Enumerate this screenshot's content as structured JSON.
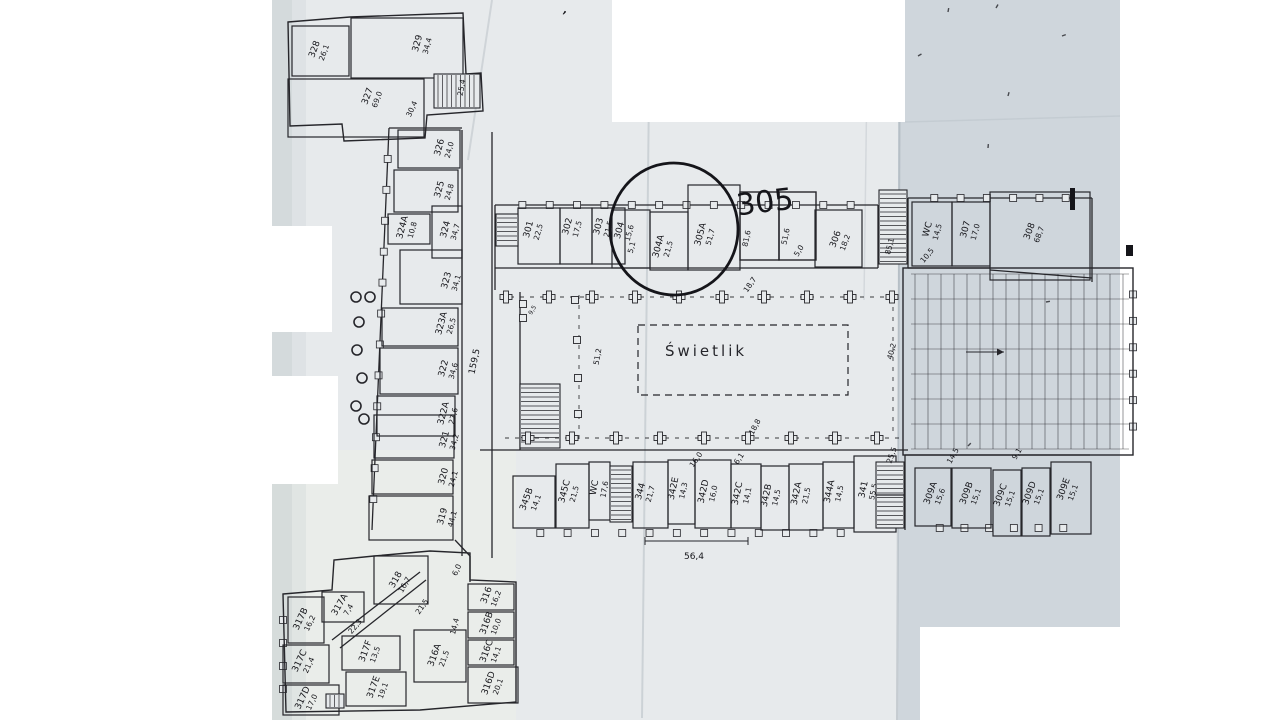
{
  "colors": {
    "bg": "#ffffff",
    "paper": "#e7eaec",
    "paper_right": "#cdd5db",
    "paper_warm": "#edeeea",
    "shadow": "#b9c2c6",
    "ink": "#26262b",
    "hand": "#15151a",
    "crease": "#8a95a0"
  },
  "paper": {
    "base": "272,0 1120,0 1120,627 920,627 920,720 272,720",
    "right": "898,0 1120,0 1120,627 920,627 920,720 898,720",
    "warm": "272,450 516,450 516,720 272,720"
  },
  "masks": [
    {
      "x": 612,
      "y": 0,
      "w": 293,
      "h": 122
    },
    {
      "x": 262,
      "y": 226,
      "w": 70,
      "h": 106
    },
    {
      "x": 256,
      "y": 376,
      "w": 82,
      "h": 108
    },
    {
      "x": 920,
      "y": 627,
      "w": 220,
      "h": 93
    }
  ],
  "creases": [
    {
      "x1": 650,
      "y1": 0,
      "x2": 642,
      "y2": 718,
      "o": 0.28,
      "w": 2
    },
    {
      "x1": 868,
      "y1": 0,
      "x2": 864,
      "y2": 300,
      "o": 0.2,
      "w": 1.5
    },
    {
      "x1": 900,
      "y1": 0,
      "x2": 897,
      "y2": 720,
      "o": 0.35,
      "w": 2
    },
    {
      "x1": 492,
      "y1": 0,
      "x2": 468,
      "y2": 160,
      "o": 0.25,
      "w": 2
    },
    {
      "x1": 905,
      "y1": 122,
      "x2": 1120,
      "y2": 116,
      "o": 0.15,
      "w": 1.5
    }
  ],
  "walls": {
    "lines": [
      {
        "x1": 462,
        "y1": 130,
        "x2": 462,
        "y2": 556
      },
      {
        "x1": 492,
        "y1": 132,
        "x2": 492,
        "y2": 290
      },
      {
        "x1": 492,
        "y1": 290,
        "x2": 492,
        "y2": 558
      },
      {
        "x1": 495,
        "y1": 205,
        "x2": 878,
        "y2": 205,
        "win": 13
      },
      {
        "x1": 495,
        "y1": 268,
        "x2": 878,
        "y2": 268
      },
      {
        "x1": 495,
        "y1": 205,
        "x2": 495,
        "y2": 290
      },
      {
        "x1": 878,
        "y1": 205,
        "x2": 878,
        "y2": 268
      },
      {
        "x1": 389,
        "y1": 128,
        "x2": 372,
        "y2": 530,
        "win": 12
      },
      {
        "x1": 389,
        "y1": 128,
        "x2": 462,
        "y2": 128
      },
      {
        "x1": 908,
        "y1": 198,
        "x2": 1092,
        "y2": 198,
        "win": 6
      },
      {
        "x1": 908,
        "y1": 198,
        "x2": 908,
        "y2": 268
      },
      {
        "x1": 1092,
        "y1": 198,
        "x2": 1092,
        "y2": 282
      },
      {
        "x1": 908,
        "y1": 268,
        "x2": 990,
        "y2": 268
      },
      {
        "x1": 990,
        "y1": 270,
        "x2": 1092,
        "y2": 278
      },
      {
        "x1": 1133,
        "y1": 268,
        "x2": 1133,
        "y2": 453,
        "win": 6,
        "only": 1
      },
      {
        "x1": 480,
        "y1": 450,
        "x2": 908,
        "y2": 450
      },
      {
        "x1": 905,
        "y1": 455,
        "x2": 1090,
        "y2": 455
      },
      {
        "x1": 513,
        "y1": 533,
        "x2": 868,
        "y2": 533,
        "win": 12,
        "only": 1
      },
      {
        "x1": 915,
        "y1": 528,
        "x2": 1088,
        "y2": 528,
        "win": 6,
        "only": 1
      },
      {
        "x1": 283,
        "y1": 597,
        "x2": 283,
        "y2": 712,
        "win": 4,
        "only": 1
      },
      {
        "x1": 455,
        "y1": 540,
        "x2": 470,
        "y2": 556
      },
      {
        "x1": 470,
        "y1": 556,
        "x2": 470,
        "y2": 582
      },
      {
        "x1": 332,
        "y1": 640,
        "x2": 420,
        "y2": 572
      },
      {
        "x1": 340,
        "y1": 648,
        "x2": 426,
        "y2": 580
      },
      {
        "x1": 905,
        "y1": 455,
        "x2": 905,
        "y2": 530
      },
      {
        "x1": 520,
        "y1": 292,
        "x2": 520,
        "y2": 450
      }
    ],
    "polys": [
      "283,594 332,590 334,560 374,556 430,551 470,553 470,580 516,582 516,702 420,710 286,712",
      "288,22 350,17 463,13 466,74 481,73 483,111 427,115 425,138 344,141 342,124 290,126"
    ],
    "rects": [
      {
        "x": 903,
        "y": 268,
        "w": 230,
        "h": 187
      },
      {
        "x": 740,
        "y": 192,
        "w": 39,
        "h": 68
      },
      {
        "x": 779,
        "y": 192,
        "w": 37,
        "h": 68
      }
    ]
  },
  "rooms": [
    {
      "id": "328",
      "area": "26,1",
      "x": 292,
      "y": 26,
      "w": 57,
      "h": 50,
      "lx": 317,
      "ly": 50,
      "rot": -70
    },
    {
      "id": "329",
      "area": "34,4",
      "x": 351,
      "y": 18,
      "w": 112,
      "h": 60,
      "lx": 420,
      "ly": 44,
      "rot": -75
    },
    {
      "id": "327",
      "area": "69,0",
      "x": 288,
      "y": 79,
      "w": 136,
      "h": 58,
      "lx": 370,
      "ly": 97,
      "rot": -70
    },
    {
      "id": "326",
      "area": "24,0",
      "x": 398,
      "y": 130,
      "w": 62,
      "h": 38,
      "lx": 442,
      "ly": 148,
      "rot": -75
    },
    {
      "id": "325",
      "area": "24,8",
      "x": 394,
      "y": 170,
      "w": 64,
      "h": 42,
      "lx": 442,
      "ly": 190,
      "rot": -75
    },
    {
      "id": "324A",
      "area": "10,8",
      "x": 388,
      "y": 214,
      "w": 42,
      "h": 30,
      "lx": 405,
      "ly": 228,
      "rot": -75
    },
    {
      "id": "324",
      "area": "34,7",
      "x": 432,
      "y": 206,
      "w": 30,
      "h": 52,
      "lx": 448,
      "ly": 230,
      "rot": -75
    },
    {
      "id": "323",
      "area": "34,1",
      "x": 400,
      "y": 250,
      "w": 62,
      "h": 54,
      "lx": 449,
      "ly": 281,
      "rot": -75
    },
    {
      "id": "323A",
      "area": "26,5",
      "x": 382,
      "y": 308,
      "w": 76,
      "h": 38,
      "lx": 444,
      "ly": 324,
      "rot": -75
    },
    {
      "id": "322",
      "area": "34,6",
      "x": 380,
      "y": 348,
      "w": 78,
      "h": 46,
      "lx": 446,
      "ly": 369,
      "rot": -75
    },
    {
      "id": "322A",
      "area": "27,6",
      "x": 377,
      "y": 396,
      "w": 78,
      "h": 40,
      "lx": 446,
      "ly": 414,
      "rot": -75
    },
    {
      "id": "321",
      "area": "34,2",
      "x": 374,
      "y": 415,
      "w": 80,
      "h": 43,
      "lx": 447,
      "ly": 440,
      "rot": -75
    },
    {
      "id": "320",
      "area": "24,1",
      "x": 372,
      "y": 460,
      "w": 81,
      "h": 34,
      "lx": 446,
      "ly": 477,
      "rot": -75
    },
    {
      "id": "319",
      "area": "44,1",
      "x": 369,
      "y": 496,
      "w": 84,
      "h": 44,
      "lx": 445,
      "ly": 517,
      "rot": -75
    },
    {
      "id": "318",
      "area": "16,7",
      "x": 374,
      "y": 556,
      "w": 54,
      "h": 48,
      "lx": 398,
      "ly": 581,
      "rot": -60
    },
    {
      "id": "317A",
      "area": "7,4",
      "x": 322,
      "y": 592,
      "w": 42,
      "h": 30,
      "lx": 342,
      "ly": 606,
      "rot": -60
    },
    {
      "id": "317B",
      "area": "16,2",
      "x": 288,
      "y": 597,
      "w": 36,
      "h": 46,
      "lx": 303,
      "ly": 620,
      "rot": -65
    },
    {
      "id": "317C",
      "area": "21,4",
      "x": 283,
      "y": 645,
      "w": 46,
      "h": 38,
      "lx": 302,
      "ly": 662,
      "rot": -65
    },
    {
      "id": "317D",
      "area": "17,0",
      "x": 283,
      "y": 685,
      "w": 56,
      "h": 30,
      "lx": 305,
      "ly": 699,
      "rot": -65
    },
    {
      "id": "317F",
      "area": "13,5",
      "x": 342,
      "y": 636,
      "w": 58,
      "h": 34,
      "lx": 368,
      "ly": 652,
      "rot": -70
    },
    {
      "id": "317E",
      "area": "19,1",
      "x": 346,
      "y": 672,
      "w": 60,
      "h": 34,
      "lx": 376,
      "ly": 688,
      "rot": -70
    },
    {
      "id": "316A",
      "area": "21,5",
      "x": 414,
      "y": 630,
      "w": 52,
      "h": 52,
      "lx": 437,
      "ly": 656,
      "rot": -70
    },
    {
      "id": "316",
      "area": "16,2",
      "x": 468,
      "y": 584,
      "w": 46,
      "h": 26,
      "lx": 489,
      "ly": 596,
      "rot": -70
    },
    {
      "id": "316B",
      "area": "10,0",
      "x": 468,
      "y": 612,
      "w": 46,
      "h": 26,
      "lx": 489,
      "ly": 624,
      "rot": -70
    },
    {
      "id": "316C",
      "area": "14,1",
      "x": 468,
      "y": 640,
      "w": 46,
      "h": 25,
      "lx": 489,
      "ly": 652,
      "rot": -70
    },
    {
      "id": "316D",
      "area": "20,1",
      "x": 468,
      "y": 667,
      "w": 50,
      "h": 36,
      "lx": 491,
      "ly": 684,
      "rot": -70
    },
    {
      "id": "301",
      "area": "22,5",
      "x": 518,
      "y": 208,
      "w": 42,
      "h": 56,
      "lx": 531,
      "ly": 230,
      "rot": -75
    },
    {
      "id": "302",
      "area": "17,5",
      "x": 560,
      "y": 208,
      "w": 32,
      "h": 56,
      "lx": 570,
      "ly": 227,
      "rot": -75
    },
    {
      "id": "303",
      "area": "21,5",
      "x": 592,
      "y": 208,
      "w": 33,
      "h": 56,
      "lx": 601,
      "ly": 227,
      "rot": -75
    },
    {
      "id": "304",
      "area": "15,6",
      "x": 612,
      "y": 210,
      "w": 38,
      "h": 58,
      "lx": 622,
      "ly": 231,
      "rot": -75
    },
    {
      "id": "304A",
      "area": "21,5",
      "x": 650,
      "y": 212,
      "w": 38,
      "h": 58,
      "lx": 661,
      "ly": 247,
      "rot": -75
    },
    {
      "id": "305A",
      "area": "51,7",
      "x": 688,
      "y": 185,
      "w": 52,
      "h": 85,
      "lx": 703,
      "ly": 235,
      "rot": -75
    },
    {
      "id": "306",
      "area": "18,2",
      "x": 815,
      "y": 210,
      "w": 47,
      "h": 57,
      "lx": 838,
      "ly": 240,
      "rot": -70
    },
    {
      "id": "WC",
      "area": "14,5",
      "x": 912,
      "y": 202,
      "w": 40,
      "h": 64,
      "lx": 930,
      "ly": 230,
      "rot": -75
    },
    {
      "id": "307",
      "area": "17,0",
      "x": 952,
      "y": 202,
      "w": 38,
      "h": 64,
      "lx": 968,
      "ly": 230,
      "rot": -75
    },
    {
      "id": "308",
      "area": "68,7",
      "x": 990,
      "y": 192,
      "w": 100,
      "h": 88,
      "lx": 1032,
      "ly": 232,
      "rot": -70
    },
    {
      "id": "345B",
      "area": "14,1",
      "x": 513,
      "y": 476,
      "w": 42,
      "h": 52,
      "lx": 529,
      "ly": 500,
      "rot": -70
    },
    {
      "id": "345C",
      "area": "21,5",
      "x": 556,
      "y": 464,
      "w": 33,
      "h": 64,
      "lx": 567,
      "ly": 492,
      "rot": -75
    },
    {
      "id": "WC",
      "area": "17,6",
      "x": 589,
      "y": 462,
      "w": 21,
      "h": 58,
      "lx": 597,
      "ly": 488,
      "rot": -80
    },
    {
      "id": "344",
      "area": "21,7",
      "x": 633,
      "y": 462,
      "w": 35,
      "h": 66,
      "lx": 643,
      "ly": 492,
      "rot": -75
    },
    {
      "id": "342E",
      "area": "14,3",
      "x": 668,
      "y": 460,
      "w": 27,
      "h": 64,
      "lx": 676,
      "ly": 489,
      "rot": -78
    },
    {
      "id": "342D",
      "area": "16,0",
      "x": 695,
      "y": 460,
      "w": 36,
      "h": 68,
      "lx": 706,
      "ly": 492,
      "rot": -78
    },
    {
      "id": "342C",
      "area": "14,1",
      "x": 731,
      "y": 464,
      "w": 30,
      "h": 64,
      "lx": 740,
      "ly": 494,
      "rot": -78
    },
    {
      "id": "342B",
      "area": "14,5",
      "x": 761,
      "y": 466,
      "w": 28,
      "h": 64,
      "lx": 769,
      "ly": 496,
      "rot": -78
    },
    {
      "id": "342A",
      "area": "21,5",
      "x": 789,
      "y": 464,
      "w": 34,
      "h": 66,
      "lx": 799,
      "ly": 494,
      "rot": -78
    },
    {
      "id": "344A",
      "area": "14,5",
      "x": 823,
      "y": 462,
      "w": 31,
      "h": 66,
      "lx": 832,
      "ly": 492,
      "rot": -78
    },
    {
      "id": "341",
      "area": "55,5",
      "x": 854,
      "y": 456,
      "w": 42,
      "h": 76,
      "lx": 866,
      "ly": 490,
      "rot": -78
    },
    {
      "id": "309A",
      "area": "15,6",
      "x": 915,
      "y": 468,
      "w": 36,
      "h": 58,
      "lx": 933,
      "ly": 494,
      "rot": -70
    },
    {
      "id": "309B",
      "area": "15,1",
      "x": 952,
      "y": 468,
      "w": 39,
      "h": 60,
      "lx": 969,
      "ly": 494,
      "rot": -70
    },
    {
      "id": "309C",
      "area": "15,1",
      "x": 993,
      "y": 470,
      "w": 28,
      "h": 66,
      "lx": 1003,
      "ly": 496,
      "rot": -70
    },
    {
      "id": "309D",
      "area": "15,1",
      "x": 1022,
      "y": 468,
      "w": 28,
      "h": 68,
      "lx": 1032,
      "ly": 494,
      "rot": -70
    },
    {
      "id": "309E",
      "area": "15,1",
      "x": 1051,
      "y": 462,
      "w": 40,
      "h": 72,
      "lx": 1066,
      "ly": 490,
      "rot": -70
    }
  ],
  "dims": [
    {
      "t": "25,4",
      "x": 464,
      "y": 88,
      "rot": -80
    },
    {
      "t": "30,4",
      "x": 414,
      "y": 110,
      "rot": -65
    },
    {
      "t": "159,5",
      "x": 477,
      "y": 362,
      "rot": -78,
      "s": 9
    },
    {
      "t": "51,2",
      "x": 600,
      "y": 357,
      "rot": -80
    },
    {
      "t": "40,2",
      "x": 894,
      "y": 352,
      "rot": -75
    },
    {
      "t": "18,8",
      "x": 757,
      "y": 428,
      "rot": -62
    },
    {
      "t": "18,7",
      "x": 752,
      "y": 286,
      "rot": -55
    },
    {
      "t": "5,0",
      "x": 801,
      "y": 252,
      "rot": -60
    },
    {
      "t": "85,1",
      "x": 892,
      "y": 247,
      "rot": -75
    },
    {
      "t": "10,5",
      "x": 929,
      "y": 257,
      "rot": -50
    },
    {
      "t": "25,5",
      "x": 894,
      "y": 456,
      "rot": -70
    },
    {
      "t": "14,5",
      "x": 955,
      "y": 457,
      "rot": -60
    },
    {
      "t": "9,1",
      "x": 1019,
      "y": 455,
      "rot": -60
    },
    {
      "t": "16,0",
      "x": 698,
      "y": 461,
      "rot": -55
    },
    {
      "t": "6,1",
      "x": 741,
      "y": 460,
      "rot": -55
    },
    {
      "t": "14,4",
      "x": 457,
      "y": 627,
      "rot": -75
    },
    {
      "t": "21,5",
      "x": 424,
      "y": 608,
      "rot": -55
    },
    {
      "t": "22,3",
      "x": 357,
      "y": 628,
      "rot": -50
    },
    {
      "t": "6,0",
      "x": 459,
      "y": 571,
      "rot": -65
    },
    {
      "t": "5,1",
      "x": 634,
      "y": 248,
      "rot": -75
    },
    {
      "t": "81,6",
      "x": 749,
      "y": 239,
      "rot": -78
    },
    {
      "t": "51,6",
      "x": 788,
      "y": 237,
      "rot": -78
    },
    {
      "t": "9,5",
      "x": 534,
      "y": 311,
      "rot": -60,
      "s": 6
    },
    {
      "t": "56,4",
      "x": 694,
      "y": 559,
      "rot": 0,
      "s": 9
    }
  ],
  "stairs": [
    {
      "x": 434,
      "y": 74,
      "w": 46,
      "h": 34,
      "dir": "v"
    },
    {
      "x": 496,
      "y": 214,
      "w": 22,
      "h": 32,
      "dir": "h"
    },
    {
      "x": 879,
      "y": 190,
      "w": 28,
      "h": 74,
      "dir": "h"
    },
    {
      "x": 520,
      "y": 384,
      "w": 40,
      "h": 64,
      "dir": "h"
    },
    {
      "x": 610,
      "y": 466,
      "w": 22,
      "h": 56,
      "dir": "h"
    },
    {
      "x": 876,
      "y": 462,
      "w": 28,
      "h": 66,
      "dir": "h",
      "div": 1
    },
    {
      "x": 326,
      "y": 694,
      "w": 18,
      "h": 14,
      "dir": "v"
    }
  ],
  "columns": {
    "cross_top": {
      "y": 297,
      "xs": [
        506,
        549,
        592,
        635,
        679,
        722,
        764,
        807,
        850,
        892
      ]
    },
    "cross_bottom": {
      "y": 438,
      "xs": [
        528,
        572,
        616,
        660,
        704,
        748,
        791,
        835,
        877
      ]
    },
    "squares": [
      [
        575,
        300
      ],
      [
        577,
        340
      ],
      [
        578,
        378
      ],
      [
        578,
        414
      ],
      [
        523,
        304
      ],
      [
        523,
        318
      ]
    ],
    "dash_lines": [
      [
        500,
        297,
        900,
        297
      ],
      [
        505,
        438,
        900,
        438
      ],
      [
        579,
        295,
        579,
        440
      ],
      [
        893,
        297,
        893,
        436
      ]
    ]
  },
  "courtyard": {
    "label": "Świetlik",
    "rect": {
      "x": 638,
      "y": 325,
      "w": 210,
      "h": 70
    },
    "lx": 706,
    "ly": 356,
    "size": 15,
    "spacing": 3
  },
  "hall": {
    "x": 903,
    "y": 268,
    "w": 230,
    "h": 187,
    "vstep": 13,
    "hstep": 25,
    "arrow": {
      "x1": 966,
      "y1": 352,
      "x2": 1004,
      "y2": 352
    }
  },
  "bracket": {
    "x1": 645,
    "x2": 748,
    "y": 541
  },
  "annotations": {
    "circle": {
      "cx": 674,
      "cy": 229,
      "rx": 64,
      "ry": 66,
      "rot": -4
    },
    "note": {
      "text": "305",
      "x": 766,
      "y": 212,
      "rot": -7,
      "size": 30
    },
    "apostrophe": {
      "text": "’",
      "x": 561,
      "y": 22
    }
  },
  "margin_circles": [
    [
      356,
      297
    ],
    [
      370,
      297
    ],
    [
      359,
      322
    ],
    [
      357,
      350
    ],
    [
      362,
      378
    ],
    [
      356,
      406
    ],
    [
      364,
      419
    ]
  ],
  "specks": [
    [
      948,
      12,
      80
    ],
    [
      996,
      8,
      60
    ],
    [
      1062,
      36,
      20
    ],
    [
      1008,
      96,
      75
    ],
    [
      988,
      148,
      85
    ],
    [
      918,
      56,
      30
    ],
    [
      1046,
      302,
      10
    ],
    [
      968,
      446,
      45
    ]
  ],
  "blobs": [
    [
      1070,
      188,
      5,
      22
    ],
    [
      1126,
      245,
      7,
      11
    ]
  ]
}
